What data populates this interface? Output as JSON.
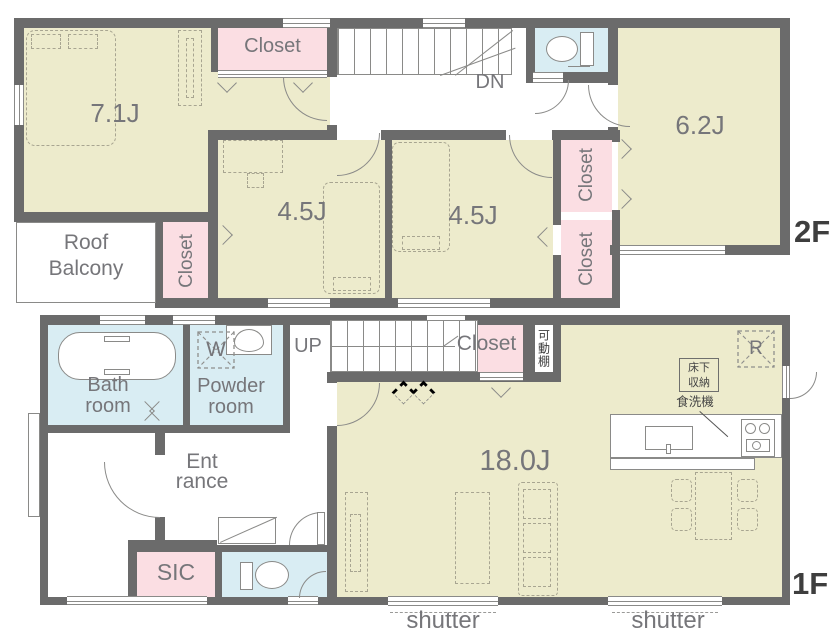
{
  "colors": {
    "wall": "#6b6b6b",
    "room_fill": "#edebcc",
    "closet_fill": "#fbdee3",
    "wet_area_fill": "#d9edf3",
    "label_text": "#76767a",
    "floor_tag_text": "#3e3e3e"
  },
  "floor2": {
    "tag": "2F",
    "bedroom_main": "7.1J",
    "bedroom_a": "4.5J",
    "bedroom_b": "4.5J",
    "bedroom_c": "6.2J",
    "closet_top": "Closet",
    "closet_balcony": "Closet",
    "closet_right_top": "Closet",
    "closet_right_bottom": "Closet",
    "stairs": "DN",
    "balcony": [
      "Roof",
      "Balcony"
    ]
  },
  "floor1": {
    "tag": "1F",
    "ldk": "18.0J",
    "bath": [
      "Bath",
      "room"
    ],
    "powder": [
      "Powder",
      "room"
    ],
    "washer": "W",
    "stairs": "UP",
    "closet": "Closet",
    "movable_shelf": "可動棚",
    "refrigerator": "R",
    "underfloor_storage": [
      "床下",
      "収納"
    ],
    "dishwasher": "食洗機",
    "entrance": [
      "Ent",
      "rance"
    ],
    "shoe_closet": "SIC",
    "shutter_left": "shutter",
    "shutter_right": "shutter"
  },
  "icons": {
    "toilet_2f": "toilet-icon",
    "toilet_1f": "toilet-icon",
    "bathtub": "bathtub-icon",
    "powder_sink": "sink-icon",
    "kitchen_sink": "kitchen-sink-icon",
    "stove": "stove-icon",
    "washer_box": "washing-machine-icon",
    "refrigerator_box": "refrigerator-icon"
  }
}
